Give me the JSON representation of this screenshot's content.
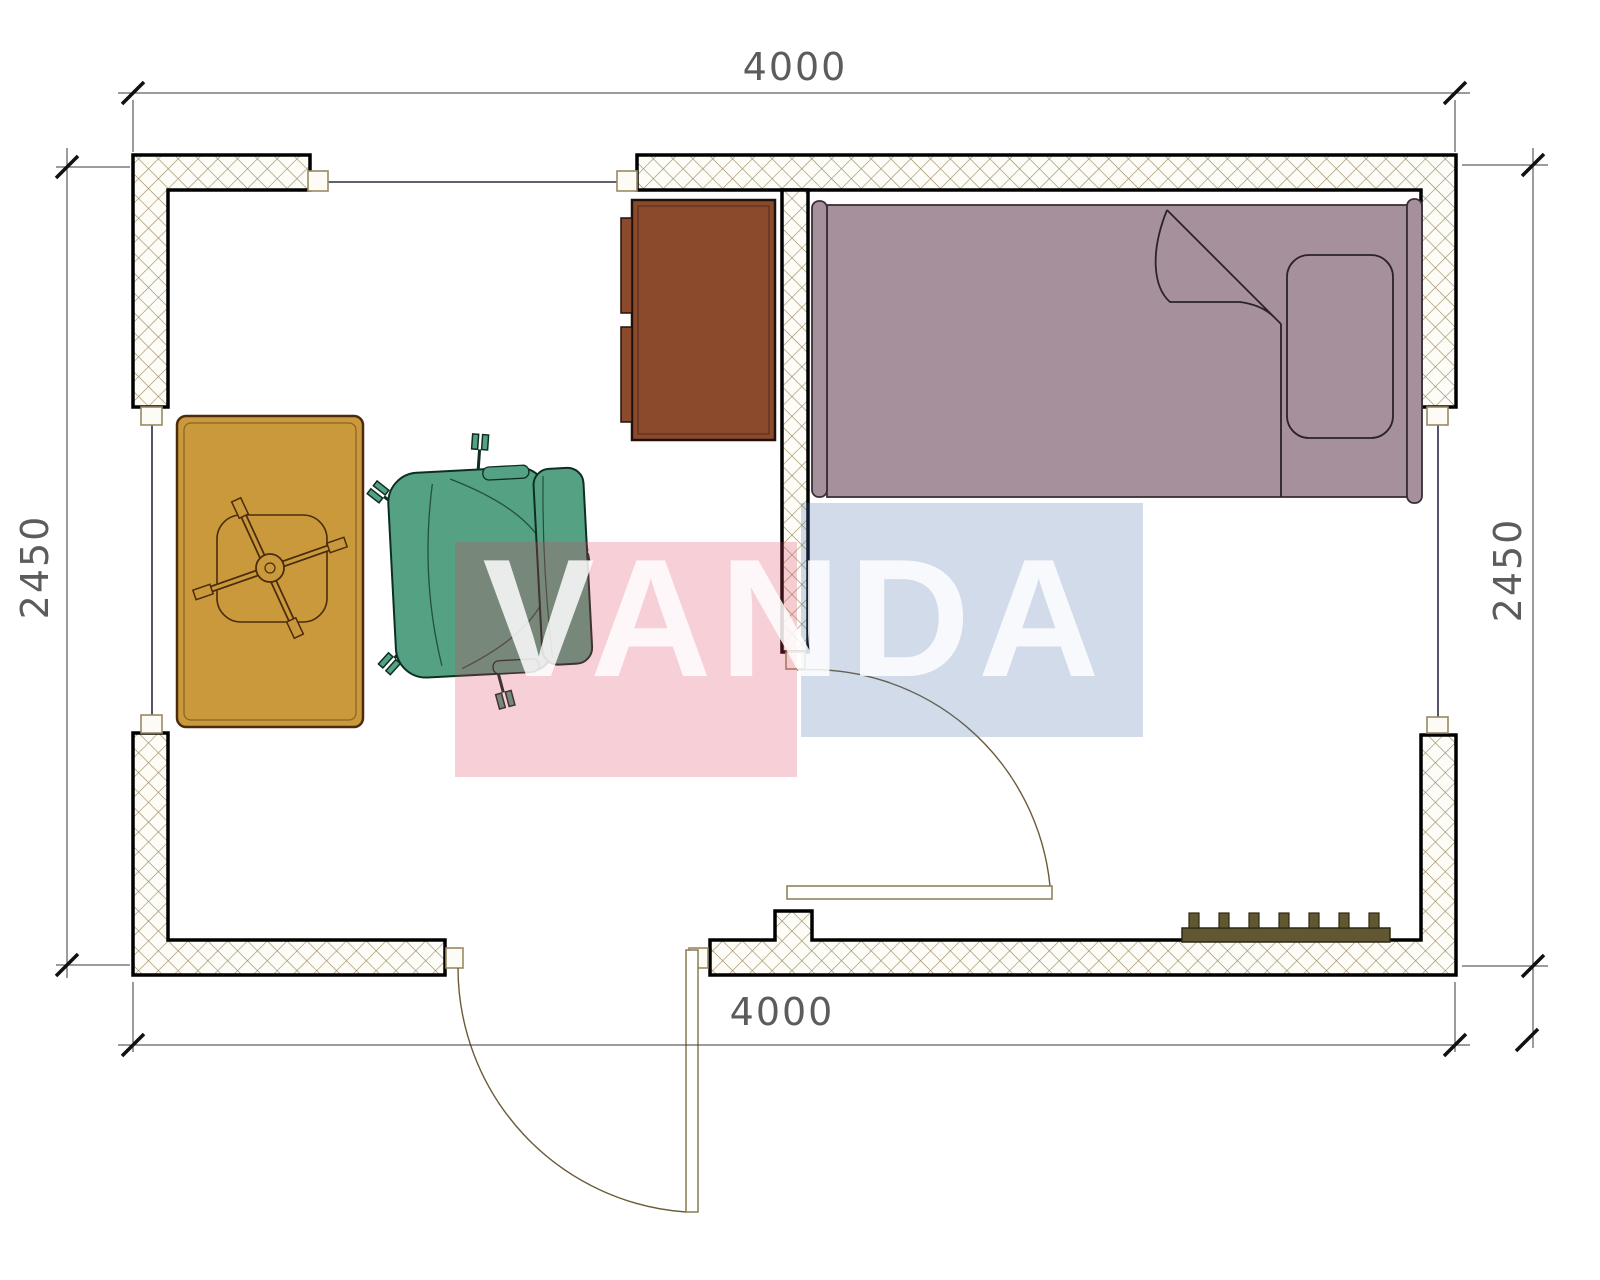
{
  "title": "Floor plan 4000 x 2450 with bed, dresser, table, office chair and radiator",
  "dims": {
    "top": "4000",
    "bottom": "4000",
    "left": "2450",
    "right": "2450"
  },
  "watermark": {
    "text": "VANDA",
    "pink": "rgba(224,62,92,0.25)",
    "blue": "rgba(72,112,170,0.25)"
  },
  "colors": {
    "wall_hatch": "#9a8a62",
    "wall_outline": "#000000",
    "window_glass": "#2a2a4a",
    "jamb_box": "#fdfbf5",
    "jamb_border": "#9a8a62",
    "dim_line": "#3a3a3a",
    "bed": "#a6909c",
    "bed_outline": "#3a2f35",
    "dresser": "#8c4a2d",
    "dresser_outline": "#22100a",
    "table": "#c9993b",
    "table_outline": "#4a2c0c",
    "chair": "#54a184",
    "chair_outline": "#0e2e22",
    "radiator": "#615732",
    "radiator_outline": "#2e2812",
    "door": "#6b5b38"
  },
  "furniture": [
    "bed",
    "pillow",
    "dresser",
    "pedestal-table",
    "office-chair",
    "radiator"
  ],
  "openings": [
    "window-top",
    "window-left",
    "window-right",
    "door-interior",
    "door-exterior"
  ]
}
